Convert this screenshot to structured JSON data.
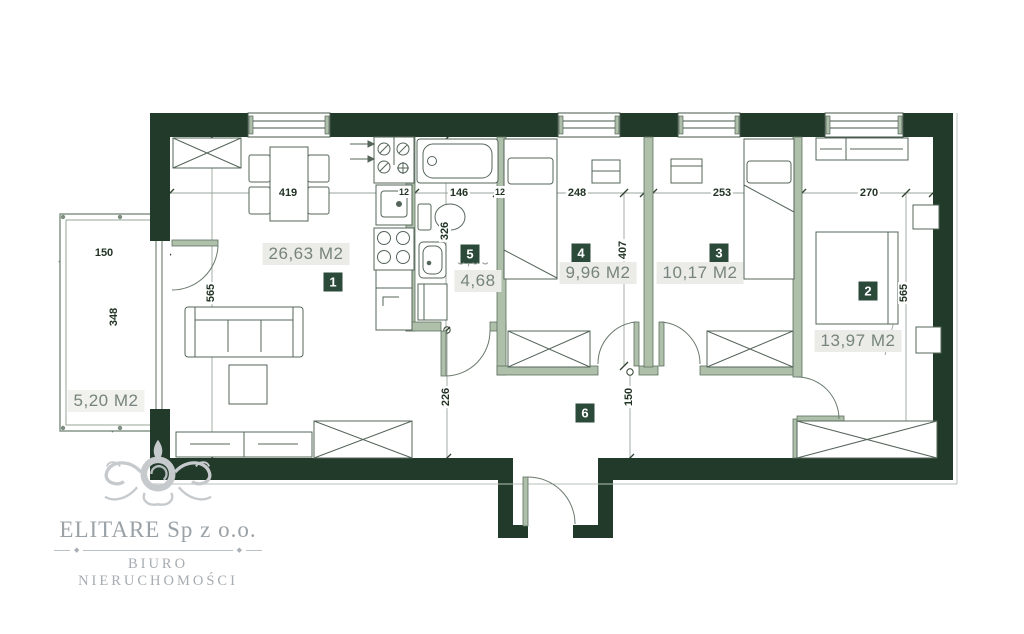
{
  "rooms": [
    {
      "number": "1",
      "area": "26,63 M2"
    },
    {
      "number": "2",
      "area": "13,97 M2"
    },
    {
      "number": "3",
      "area": "10,17 M2"
    },
    {
      "number": "4",
      "area": "9,96 M2"
    },
    {
      "number": "5",
      "area": "4,68",
      "area_hidden": "5,96"
    },
    {
      "number": "6"
    }
  ],
  "balcony": {
    "area": "5,20 M2",
    "width": "150",
    "depth": "348"
  },
  "dims": {
    "room1_width": "419",
    "bath_width": "146",
    "room4_width": "248",
    "room3_width": "253",
    "room2_width": "270",
    "wall_a": "12",
    "wall_b": "12",
    "room1_height": "565",
    "bath_height": "326",
    "room4_height": "407",
    "room2_height": "565",
    "hall_depth": "226",
    "hall_width": "150"
  },
  "logo": {
    "company": "ELITARE Sp z o.o.",
    "tagline": "BIURO NIERUCHOMOŚCI"
  },
  "colors": {
    "wall": "#223a29",
    "partition": "#afc0aa",
    "badge": "#2b4a3a",
    "area_text": "#76847b"
  }
}
